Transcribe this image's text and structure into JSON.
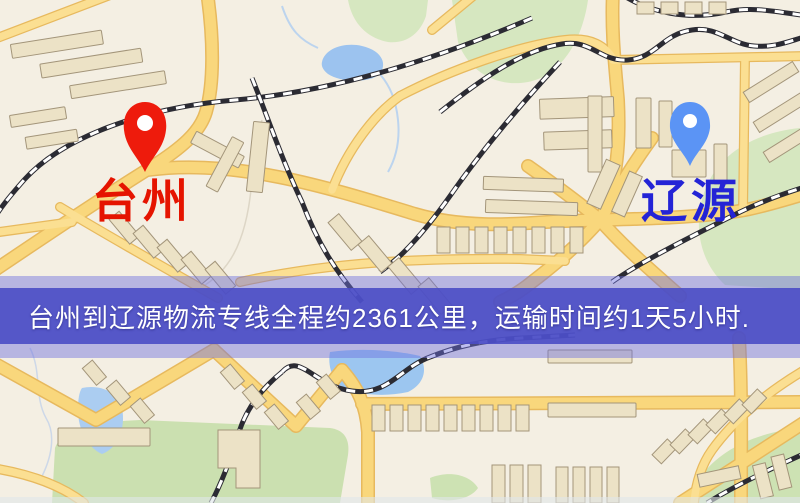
{
  "banner": {
    "text": "台州到辽源物流专线全程约2361公里，运输时间约1天5小时.",
    "background_color": "#4a4cc5",
    "text_color": "#ffffff",
    "distance_km": "2361",
    "duration": "1天5小时"
  },
  "markers": {
    "origin": {
      "label": "台州",
      "label_color": "#e51400",
      "pin_color": "#ee1b0c"
    },
    "destination": {
      "label": "辽源",
      "label_color": "#2424d6",
      "pin_color": "#5b94f5"
    }
  },
  "map_colors": {
    "background": "#f4efe3",
    "road_fill": "#f9d77c",
    "road_casing": "#e7b95e",
    "building": "#ece2c6",
    "green_area": "#d6e7c0",
    "water": "#9cc3ef",
    "railway": "#2b2b33"
  }
}
